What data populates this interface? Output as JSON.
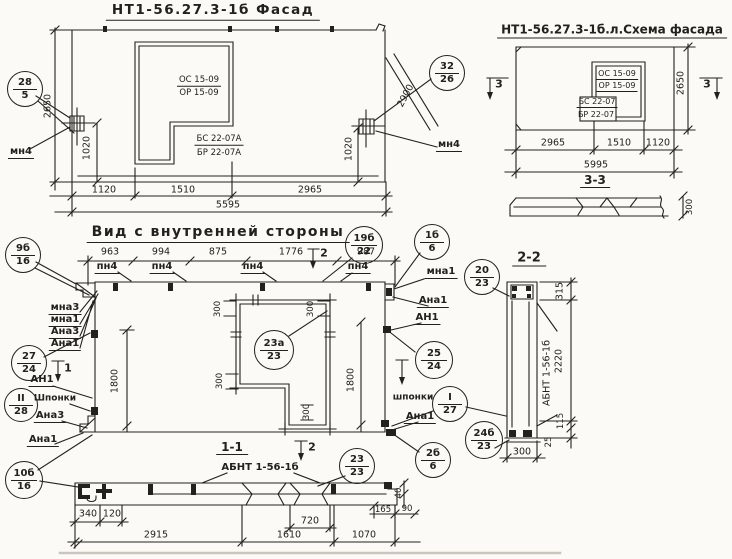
{
  "colors": {
    "ink": "#23211c",
    "paper": "#fbfaf6"
  },
  "facade": {
    "title": "НТ1-56.27.3-1б Фасад",
    "os": "ОС 15-09",
    "or": "ОР 15-09",
    "bs": "БС 22-07А",
    "br": "БР 22-07А",
    "mn4": "мн4",
    "h2650": "2650",
    "v1020": "1020",
    "diag2900": "2900",
    "d1120": "1120",
    "d1510": "1510",
    "d2965": "2965",
    "total": "5595"
  },
  "schema": {
    "title": "НТ1-56.27.3-1б.л.Схема фасада",
    "os": "ОС 15-09",
    "or": "ОР 15-09",
    "bs": "БС 22-07",
    "br": "БР 22-07",
    "mark": "3",
    "h2650": "2650",
    "d2965": "2965",
    "d1510": "1510",
    "d1120": "1120",
    "total": "5995",
    "s33_title": "3-3",
    "s33_300": "300"
  },
  "inner": {
    "title": "Вид с внутренней стороны",
    "d963": "963",
    "d994": "994",
    "d875": "875",
    "d1776": "1776",
    "d987": "987",
    "pn4": "пн4",
    "mark2": "2",
    "mark1": "1",
    "mna3": "мна3",
    "mna1": "мна1",
    "ana3": "Ана3",
    "ana1": "Ана1",
    "an1": "АН1",
    "shponki_cap": "Шпонки",
    "shponki": "шпонки",
    "d1800": "1800",
    "d300": "300"
  },
  "s22": {
    "title": "2-2",
    "panel_label": "АБНТ 1-56-1б",
    "d315": "315",
    "d2220": "2220",
    "d115": "115",
    "d25": "25",
    "d300": "300"
  },
  "s11": {
    "title": "1-1",
    "label": "АБНТ 1-56-1б",
    "d340": "340",
    "d120": "120",
    "d2915": "2915",
    "d720": "720",
    "d1610": "1610",
    "d1070": "1070",
    "d165": "165",
    "d90": "90",
    "d40": "40"
  },
  "balloons": {
    "b28_5": {
      "top": "28",
      "bot": "5"
    },
    "b32_26": {
      "top": "32",
      "bot": "26"
    },
    "b9b_16": {
      "top": "9б",
      "bot": "16"
    },
    "b19b_22": {
      "top": "19б",
      "bot": "22"
    },
    "b1b_6": {
      "top": "1б",
      "bot": "6"
    },
    "b27_24": {
      "top": "27",
      "bot": "24"
    },
    "bII_28": {
      "top": "II",
      "bot": "28"
    },
    "b10b_16": {
      "top": "10б",
      "bot": "16"
    },
    "b23a_23": {
      "top": "23а",
      "bot": "23"
    },
    "b25_24": {
      "top": "25",
      "bot": "24"
    },
    "bI_27": {
      "top": "I",
      "bot": "27"
    },
    "b2b_6": {
      "top": "2б",
      "bot": "6"
    },
    "b20_23": {
      "top": "20",
      "bot": "23"
    },
    "b24b_23": {
      "top": "24б",
      "bot": "23"
    },
    "b23_23": {
      "top": "23",
      "bot": "23"
    }
  }
}
